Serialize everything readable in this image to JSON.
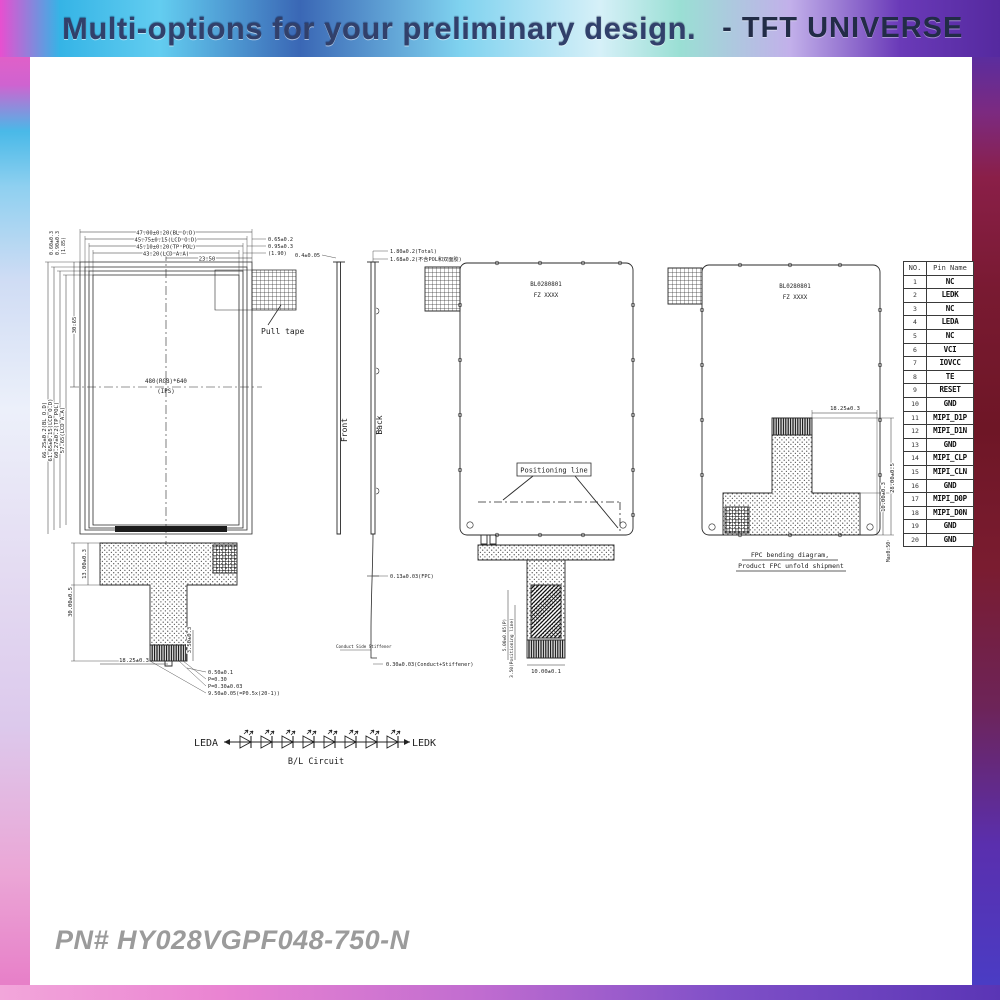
{
  "header": {
    "title": "Multi-options for your preliminary design.",
    "brand": "-  TFT UNIVERSE"
  },
  "footer": {
    "part_number": "PN# HY028VGPF048-750-N"
  },
  "front_view": {
    "screen_label_line1": "480(RGB)*640",
    "screen_label_line2": "(IPS)",
    "pull_tape_label": "Pull tape",
    "dims_top": [
      "47.00±0.20(BL O.D)",
      "45.75±0.15(LCD O.D)",
      "45.10±0.20(TP POL)",
      "43.20(LCD A.A)",
      "23.50"
    ],
    "dims_top_right": [
      "0.65±0.2",
      "0.95±0.3",
      "(1.90)"
    ],
    "dims_left": [
      "66.25±0.2(BL O.D)",
      "61.65±0.15(LCD O.D)",
      "60.27±0.2(TP POL)",
      "57.65(LCD A.A)"
    ],
    "dims_left_small": [
      "0.60±0.3",
      "0.90±0.3",
      "(1.85)"
    ],
    "center_dim": "30.65",
    "fpc": {
      "height_upper": "13.00±0.3",
      "height_total": "30.00±0.5",
      "offset_x": "18.25±0.3",
      "tail_height": "3.50±0.3",
      "pin_dims": [
        "0.50±0.1",
        "P=0.30",
        "P=0.30±0.03",
        "9.50±0.05(=P0.5x(20-1))"
      ]
    }
  },
  "side_view": {
    "front_label": "Front",
    "back_label": "Back",
    "dims": {
      "pol": "0.4±0.05",
      "total": "1.80±0.2(Total)",
      "no_pol": "1.68±0.2(不含POL和双面胶)",
      "fpc": "0.13±0.03(FPC)",
      "conduct_note": "Conduct Side Stiffener",
      "conduct": "0.30±0.03(Conduct+Stiffener)"
    }
  },
  "back_view": {
    "marking_line1": "BL0280801",
    "marking_line2": "FZ XXXX",
    "positioning_label": "Positioning line",
    "tail_width": "10.00±0.1",
    "tail_pitch": "5.00±0.05(P)",
    "tail_pos": "3.50(Positioning line)"
  },
  "folded_view": {
    "marking_line1": "BL0280801",
    "marking_line2": "FZ XXXX",
    "dim_offset": "18.25±0.3",
    "dim_h1": "10.00±0.3",
    "dim_h2": "28.00±0.5",
    "dim_max": "Max0.50",
    "caption_line1": "FPC bending diagram,",
    "caption_line2": "Product FPC unfold shipment"
  },
  "pin_table": {
    "headers": [
      "NO.",
      "Pin Name"
    ],
    "rows": [
      {
        "no": "1",
        "name": "NC"
      },
      {
        "no": "2",
        "name": "LEDK"
      },
      {
        "no": "3",
        "name": "NC"
      },
      {
        "no": "4",
        "name": "LEDA"
      },
      {
        "no": "5",
        "name": "NC"
      },
      {
        "no": "6",
        "name": "VCI"
      },
      {
        "no": "7",
        "name": "IOVCC"
      },
      {
        "no": "8",
        "name": "TE"
      },
      {
        "no": "9",
        "name": "RESET"
      },
      {
        "no": "10",
        "name": "GND"
      },
      {
        "no": "11",
        "name": "MIPI_D1P"
      },
      {
        "no": "12",
        "name": "MIPI_D1N"
      },
      {
        "no": "13",
        "name": "GND"
      },
      {
        "no": "14",
        "name": "MIPI_CLP"
      },
      {
        "no": "15",
        "name": "MIPI_CLN"
      },
      {
        "no": "16",
        "name": "GND"
      },
      {
        "no": "17",
        "name": "MIPI_D0P"
      },
      {
        "no": "18",
        "name": "MIPI_D0N"
      },
      {
        "no": "19",
        "name": "GND"
      },
      {
        "no": "20",
        "name": "GND"
      }
    ]
  },
  "bl_circuit": {
    "anode_label": "LEDA",
    "cathode_label": "LEDK",
    "caption": "B/L Circuit",
    "led_count": 8
  }
}
